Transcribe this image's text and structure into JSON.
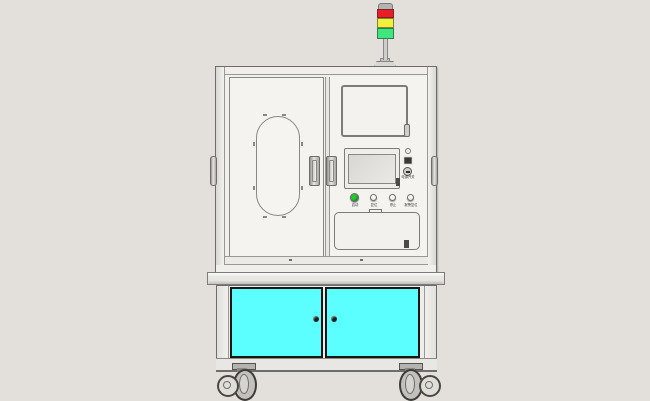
{
  "scene": {
    "type": "cad-render",
    "description": "Front orthographic CAD render of an industrial automation test machine on casters",
    "background_color": "#e3e0dc"
  },
  "tower_light": {
    "segments": [
      {
        "name": "red",
        "color": "#ea1c24"
      },
      {
        "name": "yellow",
        "color": "#f2ef3d"
      },
      {
        "name": "green",
        "color": "#3fe57d"
      }
    ]
  },
  "upper_cabinet": {
    "power_switch_label": "电源开关",
    "buttons": [
      {
        "label": "启动",
        "color": "#27c832"
      },
      {
        "label": "复位",
        "color": "#f5f3f0"
      },
      {
        "label": "停止",
        "color": "#f5f3f0"
      },
      {
        "label": "报警复位",
        "color": "#f5f3f0"
      }
    ]
  },
  "lower_cabinet": {
    "door_color": "#5cffff"
  }
}
